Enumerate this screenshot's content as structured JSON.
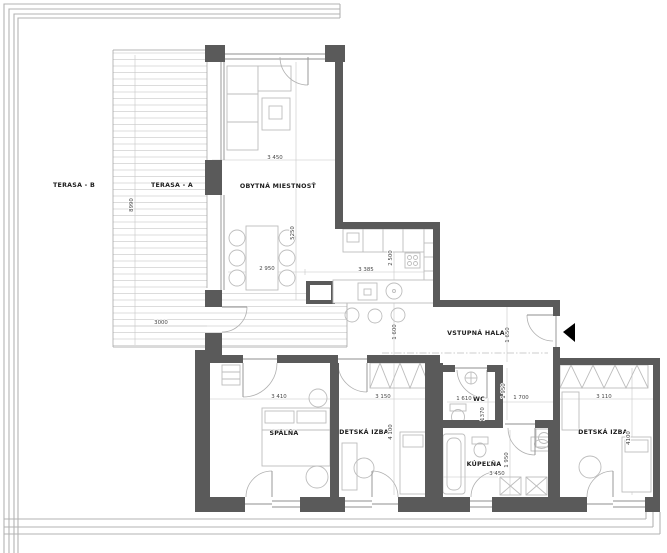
{
  "plan_title": "apartment floor plan",
  "colors": {
    "wall": "#5a5a5a",
    "thin_line": "#9c9c9c",
    "furniture_line": "#bdbdbd",
    "label_text": "#1c1c1c",
    "dim_text": "#474747",
    "entrance_arrow": "#000000"
  },
  "rooms": {
    "terasa_b": "TERASA - B",
    "terasa_a": "TERASA - A",
    "obytna_miestnost": "OBYTNÁ MIESTNOSŤ",
    "vstupna_hala": "VSTUPNÁ HALA",
    "spalna": "SPÁLŇA",
    "detska_izba_1": "DETSKÁ IZBA",
    "wc": "WC",
    "kupelna": "KÚPEĽŇA",
    "detska_izba_2": "DETSKÁ IZBA"
  },
  "dimensions": {
    "living_width": "3 450",
    "living_depth": "5250",
    "dining_width": "2 950",
    "kitchen_width": "3 385",
    "kitchen_depth": "2 500",
    "passage_width": "1 600",
    "entry_width": "1 650",
    "terrace_depth": "8990",
    "terrace_width": "3000",
    "spalna_width": "3 410",
    "detska1_width": "3 150",
    "detska1_depth": "4 100",
    "wc_width": "1 610",
    "hall_closet_width": "1 700",
    "wc_depth": "1370",
    "wc_zone_depth": "1 950",
    "kupelna_width": "3 450",
    "kupelna_depth": "1 950",
    "detska2_width": "3 110",
    "detska2_depth": "4100"
  }
}
